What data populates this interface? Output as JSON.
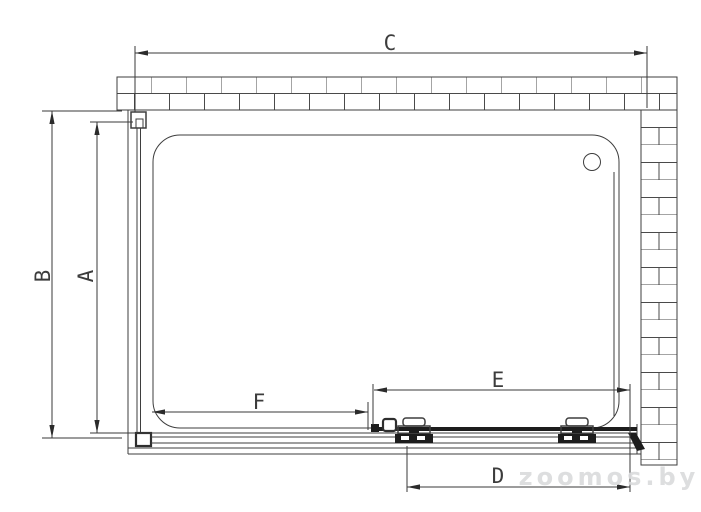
{
  "diagram": {
    "type": "technical-drawing",
    "subject": "Shower enclosure with sliding door - top view installation plan",
    "dimensions": {
      "top_width": "C",
      "outer_depth": "B",
      "inner_depth": "A",
      "door_opening": "D",
      "sliding_panel": "E",
      "fixed_front_panel": "F"
    },
    "watermark": "zoomos.by",
    "colors": {
      "line": "#3e3e3e",
      "dark_fill": "#1d1d1d",
      "watermark": "#dadbdc",
      "background": "#ffffff"
    }
  }
}
